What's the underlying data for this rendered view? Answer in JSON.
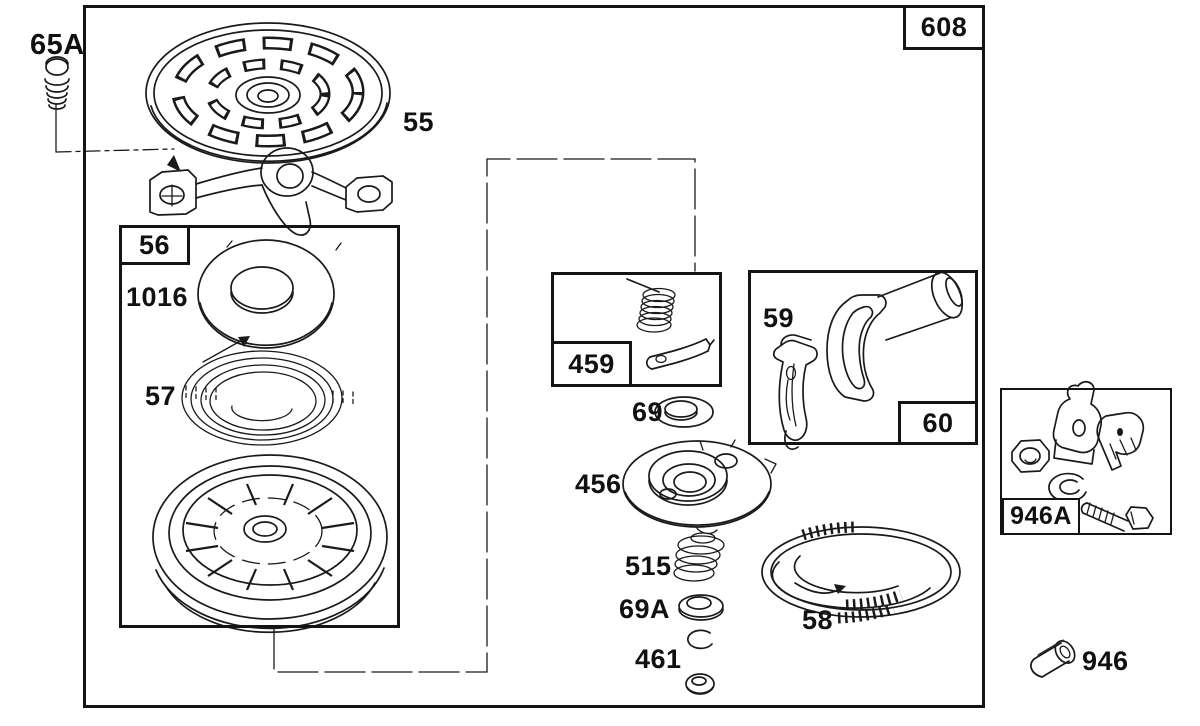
{
  "canvas": {
    "background": "#ffffff",
    "ink": "#1a1a1a"
  },
  "group_boxes": {
    "starter_assembly": "608",
    "pulley_assembly": "56",
    "pawl_spring_kit": "459",
    "handle_grip": "60",
    "hardware_kit": "946A"
  },
  "callouts": {
    "mounting_screw": "65A",
    "blower_housing": "55",
    "spring_washer": "1016",
    "recoil_spring": "57",
    "washer_69": "69",
    "pulley_plate": "456",
    "handle_insert": "59",
    "brake_spring": "515",
    "washer_69a": "69A",
    "retainer": "461",
    "starter_rope": "58",
    "rope_clip": "946"
  }
}
